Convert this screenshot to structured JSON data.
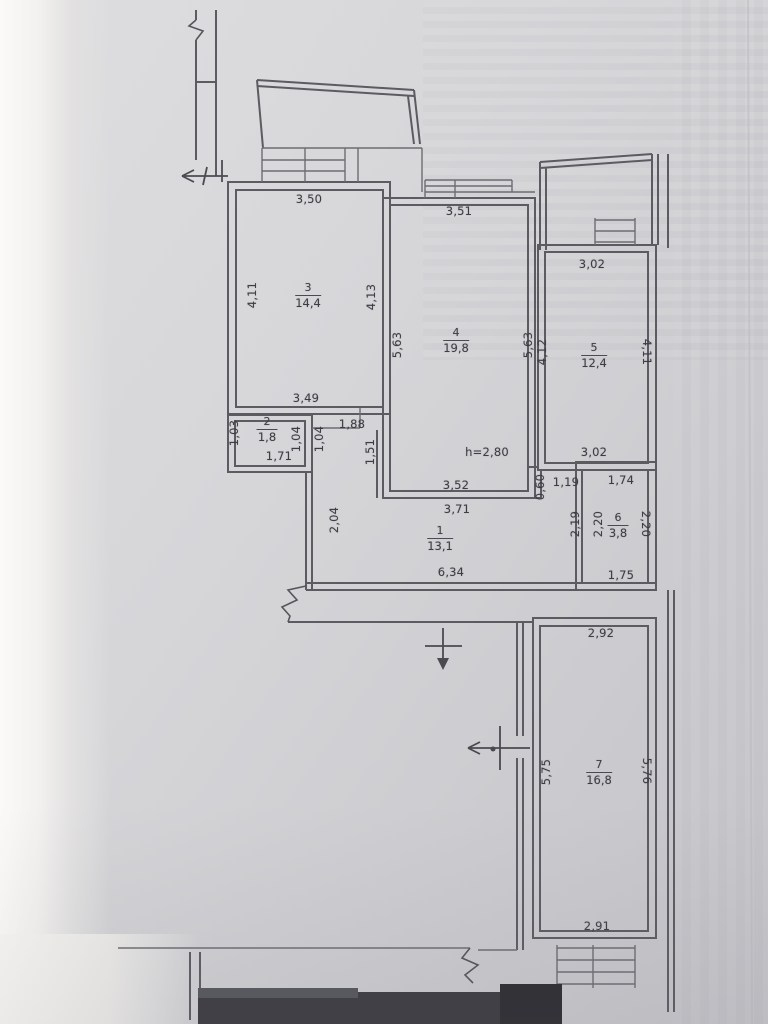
{
  "plan": {
    "height_label": "h=2,80",
    "rooms": {
      "r1": {
        "number": "1",
        "area": "13,1"
      },
      "r2": {
        "number": "2",
        "area": "1,8"
      },
      "r3": {
        "number": "3",
        "area": "14,4"
      },
      "r4": {
        "number": "4",
        "area": "19,8"
      },
      "r5": {
        "number": "5",
        "area": "12,4"
      },
      "r6": {
        "number": "6",
        "area": "3,8"
      },
      "r7": {
        "number": "7",
        "area": "16,8"
      }
    },
    "dims": {
      "r3_top": "3,50",
      "r3_bottom": "3,49",
      "r3_left": "4,11",
      "r3_right": "4,13",
      "r4_top": "3,51",
      "r4_left": "5,63",
      "r4_right": "5,63",
      "r4_bottom_inner": "3,52",
      "r4_bottom_outer": "3,71",
      "r5_top": "3,02",
      "r5_bottom": "3,02",
      "r5_left": "4,12",
      "r5_right": "4,11",
      "r2_left": "1,03",
      "r2_bottom": "1,71",
      "r2_right": "1,04",
      "wall_right_of_r2": "1,04",
      "nook_width": "1,88",
      "nook_height": "1,51",
      "corridor_left": "2,04",
      "corridor_bottom": "6,34",
      "niche_step": "0,60",
      "niche_width": "1,19",
      "niche_depth": "2,19",
      "r6_top": "1,74",
      "r6_bottom": "1,75",
      "r6_left": "2,20",
      "r6_right": "2,20",
      "r7_top": "2,92",
      "r7_bottom": "2,91",
      "r7_left": "5,75",
      "r7_right": "5,76"
    }
  }
}
